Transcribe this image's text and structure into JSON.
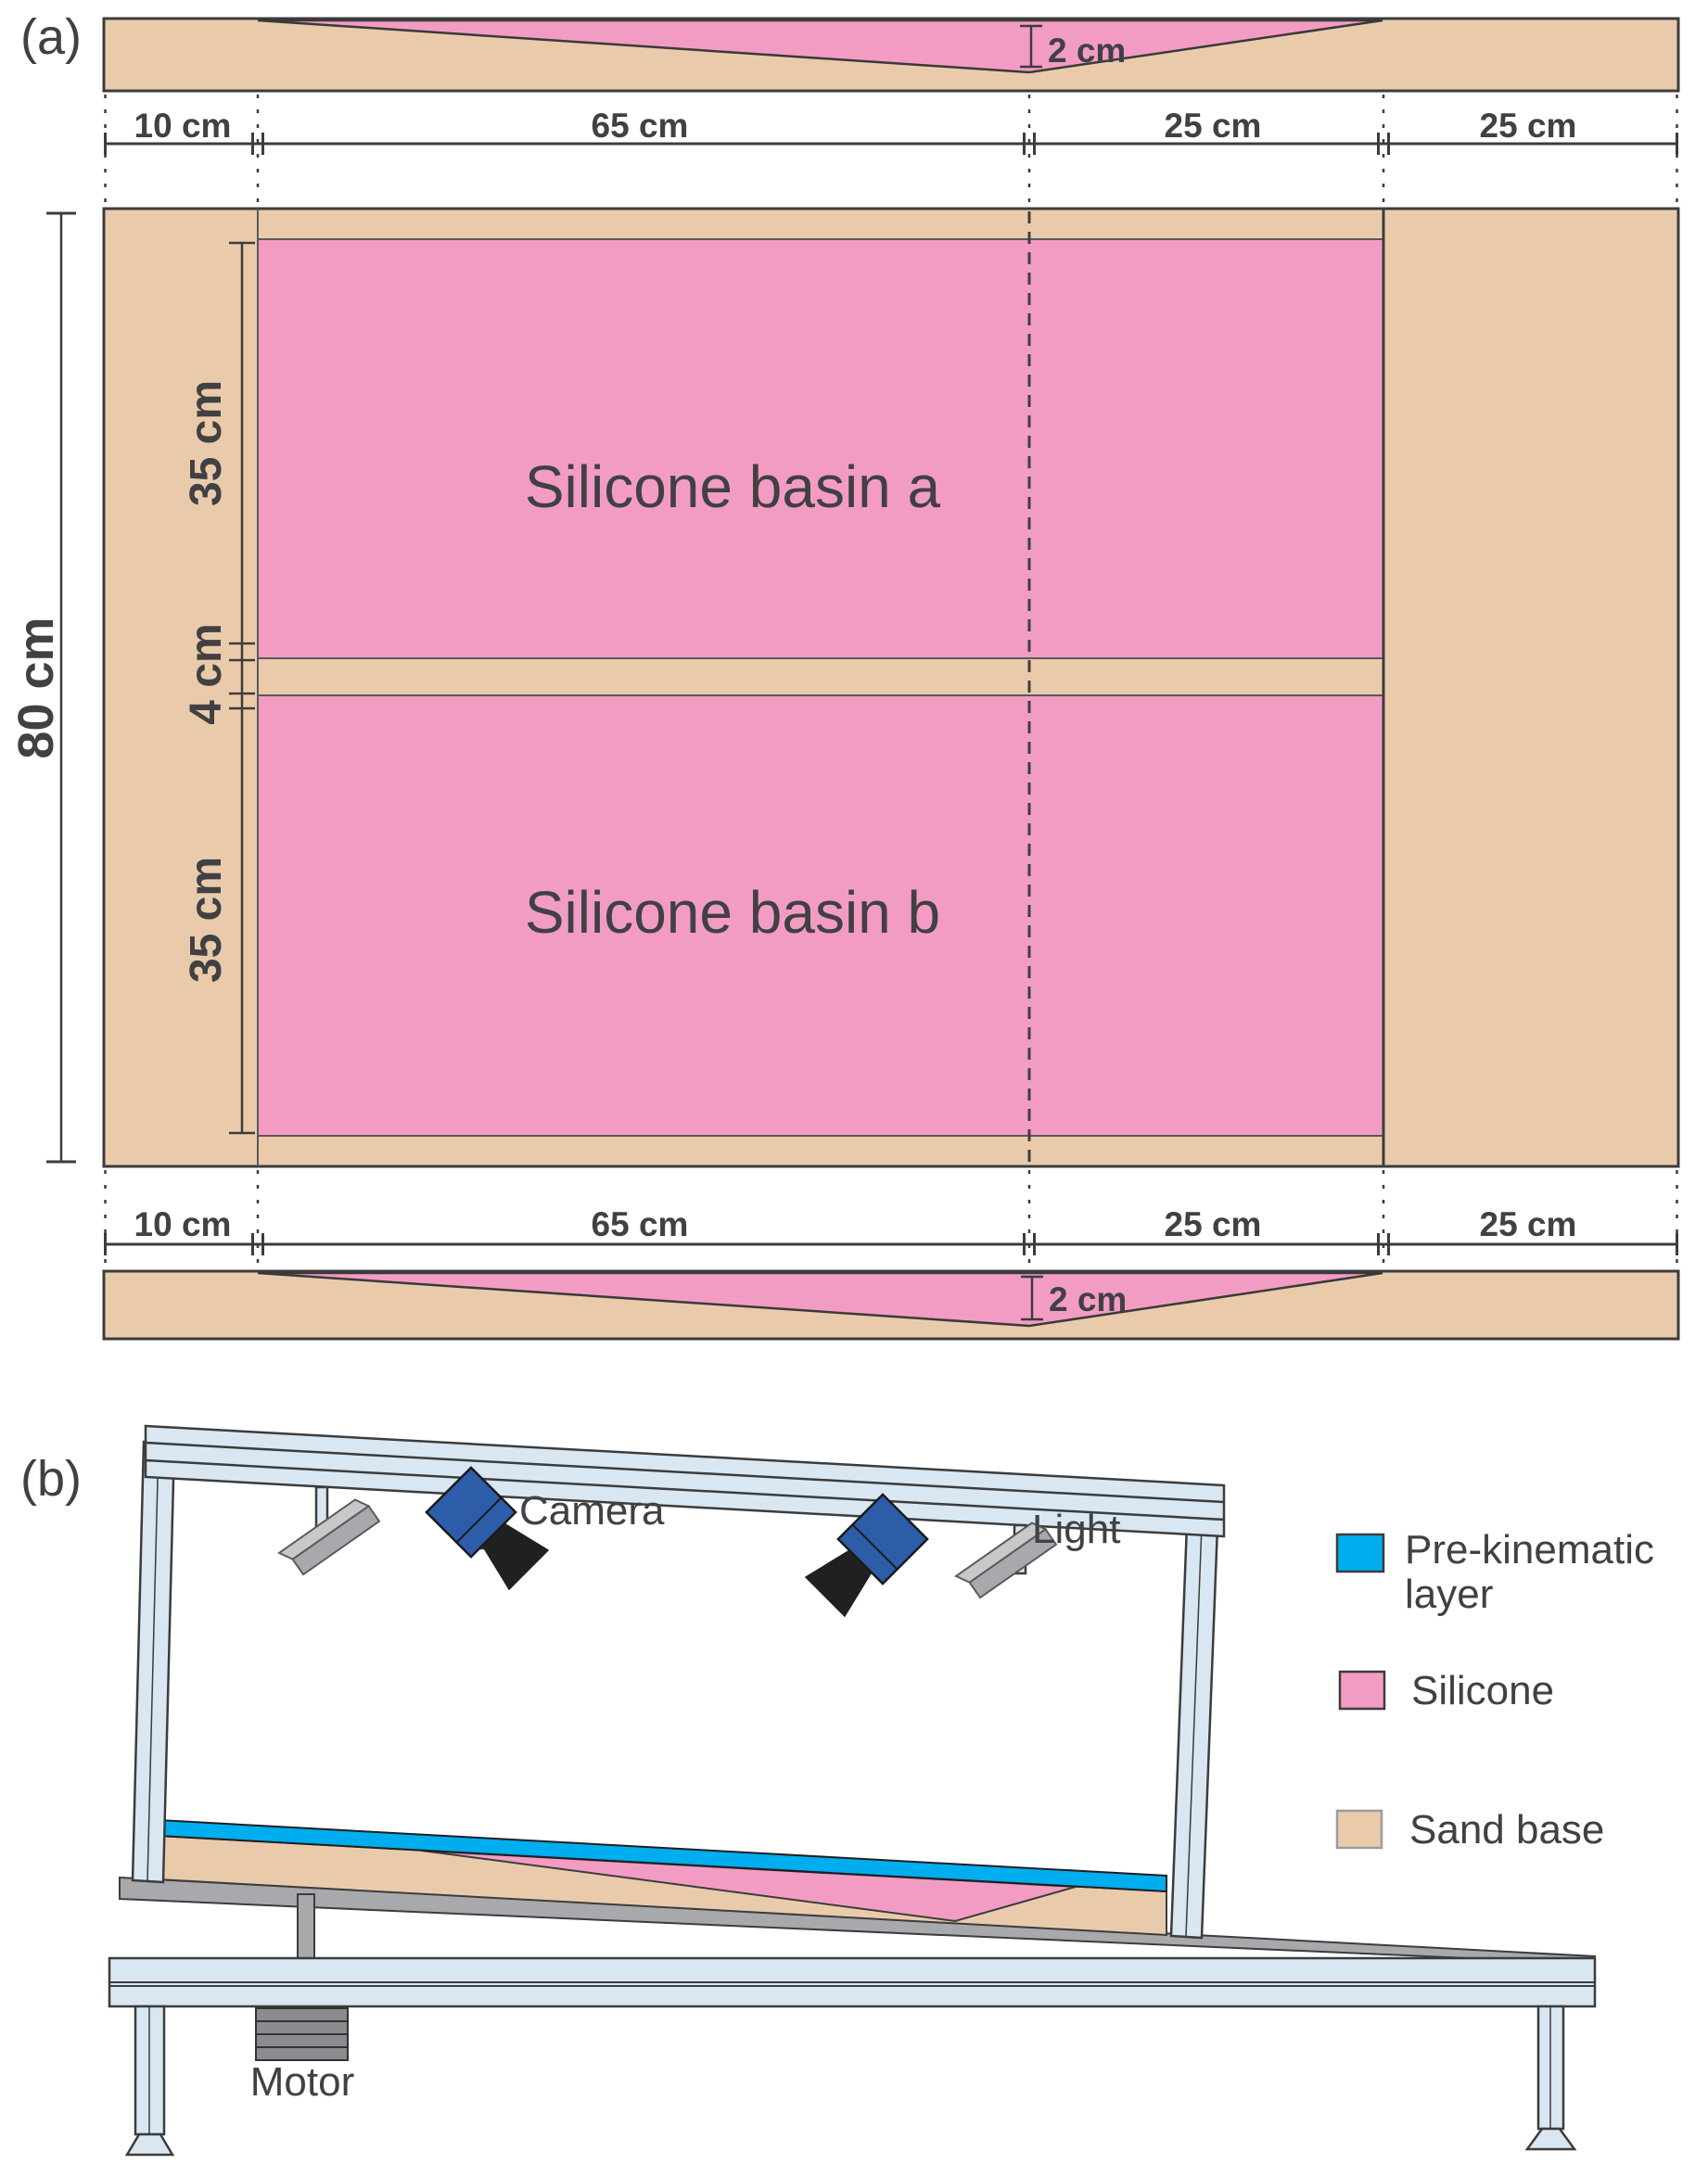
{
  "figure_type": "experimental-apparatus-diagram",
  "panel_a": {
    "tag": "(a)",
    "cross_section_top": {
      "depth_label": "2 cm"
    },
    "cross_section_bottom": {
      "depth_label": "2 cm"
    },
    "width_segments": [
      {
        "label": "10 cm"
      },
      {
        "label": "65 cm"
      },
      {
        "label": "25 cm"
      },
      {
        "label": "25 cm"
      }
    ],
    "height_label": "80 cm",
    "inner_segments": [
      {
        "label": "35 cm"
      },
      {
        "label": "4 cm"
      },
      {
        "label": "35 cm"
      }
    ],
    "basins": [
      {
        "label": "Silicone basin a"
      },
      {
        "label": "Silicone basin b"
      }
    ]
  },
  "panel_b": {
    "tag": "(b)",
    "equipment": {
      "camera": "Camera",
      "light": "Light",
      "motor": "Motor"
    },
    "legend": {
      "items": [
        {
          "id": "pre-kinematic-layer",
          "swatch_color": "#00aeef",
          "lines": [
            "Pre-kinematic",
            "layer"
          ]
        },
        {
          "id": "silicone",
          "swatch_color": "#f29cc4",
          "lines": [
            "Silicone"
          ]
        },
        {
          "id": "sand-base",
          "swatch_color": "#e9cbab",
          "lines": [
            "Sand base"
          ]
        }
      ]
    }
  },
  "colors": {
    "sand_base": "#e9cbab",
    "silicone": "#f29cc4",
    "pre_kinematic_layer": "#00aeef",
    "frame": "#d9e7f2",
    "base_board": "#a7a9ac",
    "motor": "#8a8c8f",
    "camera_body": "#2d5da9",
    "camera_lens": "#1f2022",
    "outline": "#3c3c3c",
    "text": "#414042"
  }
}
